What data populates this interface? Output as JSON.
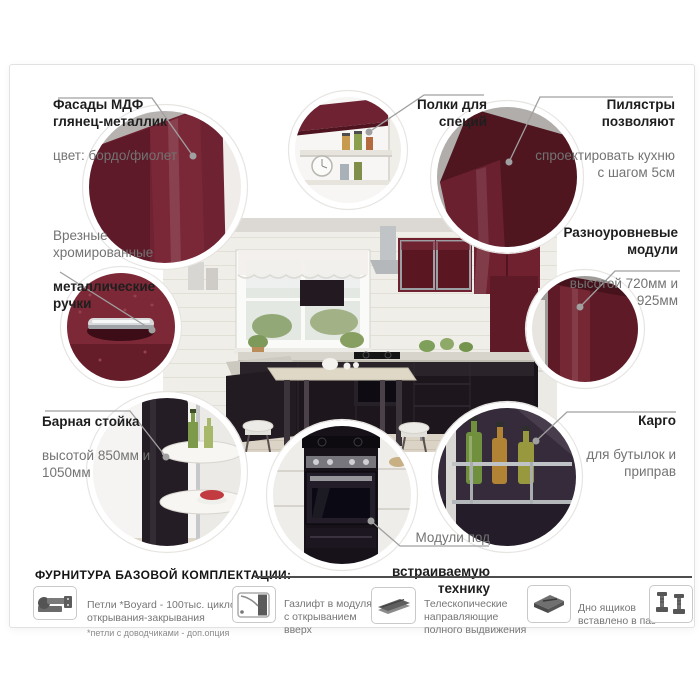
{
  "callouts": [
    {
      "id": "facades",
      "bold": "Фасады МДФ\nглянец-металлик",
      "regular": "цвет: бордо/фиолет"
    },
    {
      "id": "spice-shelves",
      "bold": "Полки для\nспеций",
      "regular": ""
    },
    {
      "id": "pilasters",
      "bold": "Пилястры\nпозволяют",
      "regular": "спроектировать кухню\nс шагом 5см"
    },
    {
      "id": "handles",
      "bold": "металлические\nручки",
      "regular": "Врезные\nхромированные"
    },
    {
      "id": "modules",
      "bold": "Разноуровневые\nмодули",
      "regular": "высотой 720мм и\n925мм"
    },
    {
      "id": "bar-counter",
      "bold": "Барная стойка",
      "regular": "высотой 850мм и\n1050мм"
    },
    {
      "id": "built-in",
      "bold": "встраиваемую\nтехнику",
      "regular": "Модули под"
    },
    {
      "id": "cargo",
      "bold": "Карго",
      "regular": "для бутылок и\nприправ"
    }
  ],
  "hardware": {
    "header": "ФУРНИТУРА БАЗОВОЙ КОМПЛЕКТАЦИИ:",
    "items": [
      {
        "icon": "hinge-icon",
        "text": "Петли *Boyard - 100тыс. циклов\nоткрывания-закрывания",
        "note": "*петли с доводчиками - доп.опция"
      },
      {
        "icon": "gas-lift-icon",
        "text": "Газлифт в модулях\nс открыванием\nвверх",
        "note": ""
      },
      {
        "icon": "telescopic-slides-icon",
        "text": "Телескопические\nнаправляющие\nполного выдвижения",
        "note": ""
      },
      {
        "icon": "drawer-bottom-icon",
        "text": "Дно ящиков\nвставлено в паз",
        "note": ""
      },
      {
        "icon": "adjustable-feet-icon",
        "text": "",
        "note": ""
      }
    ]
  },
  "colors": {
    "accent_burgundy": "#6d2230",
    "dark_cabinet": "#1c161c",
    "text_dark": "#1e1e1e",
    "text_gray": "#737373",
    "leader_line": "#a0a0a0"
  }
}
